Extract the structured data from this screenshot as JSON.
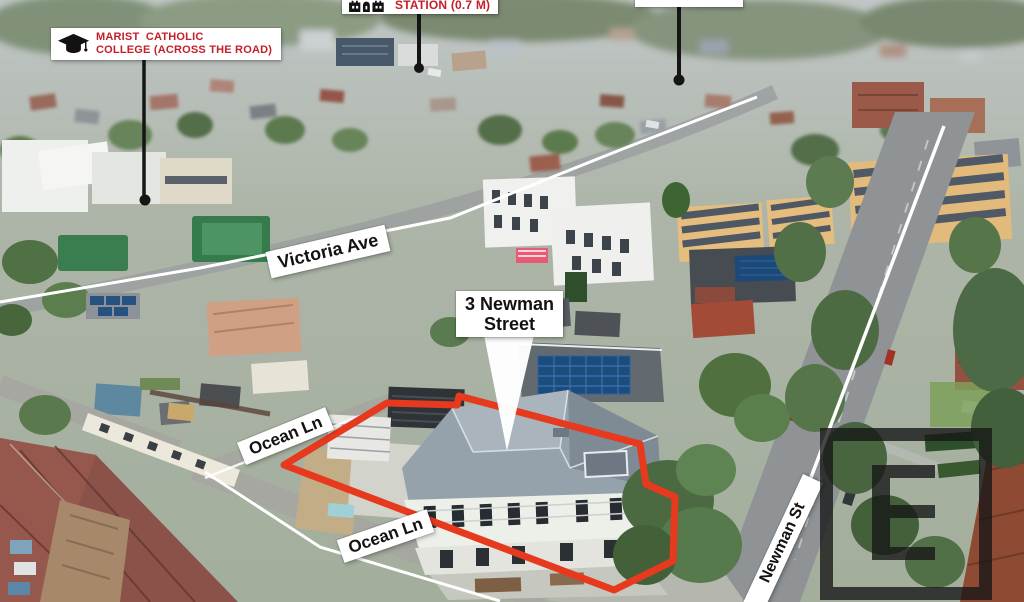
{
  "annotations": {
    "college_label": {
      "icon": "graduation-cap",
      "line1": "MARIST  CATHOLIC",
      "line2": "COLLEGE (ACROSS THE ROAD)"
    },
    "station_label": {
      "icon": "train-station",
      "text": "STATION (0.7 M)"
    },
    "property_callout": {
      "line1": "3 Newman",
      "line2": "Street"
    },
    "street_labels": {
      "victoria_ave": "Victoria Ave",
      "ocean_ln_upper": "Ocean Ln",
      "ocean_ln_lower": "Ocean Ln",
      "newman_st": "Newman St"
    }
  },
  "colors": {
    "annotation_red_text": "#c3202a",
    "annotation_black_text": "#121212",
    "label_background": "#ffffff",
    "property_outline": "#e6391e",
    "pointer": "#151515",
    "street_line": "#ffffff",
    "watermark": "#161616"
  }
}
